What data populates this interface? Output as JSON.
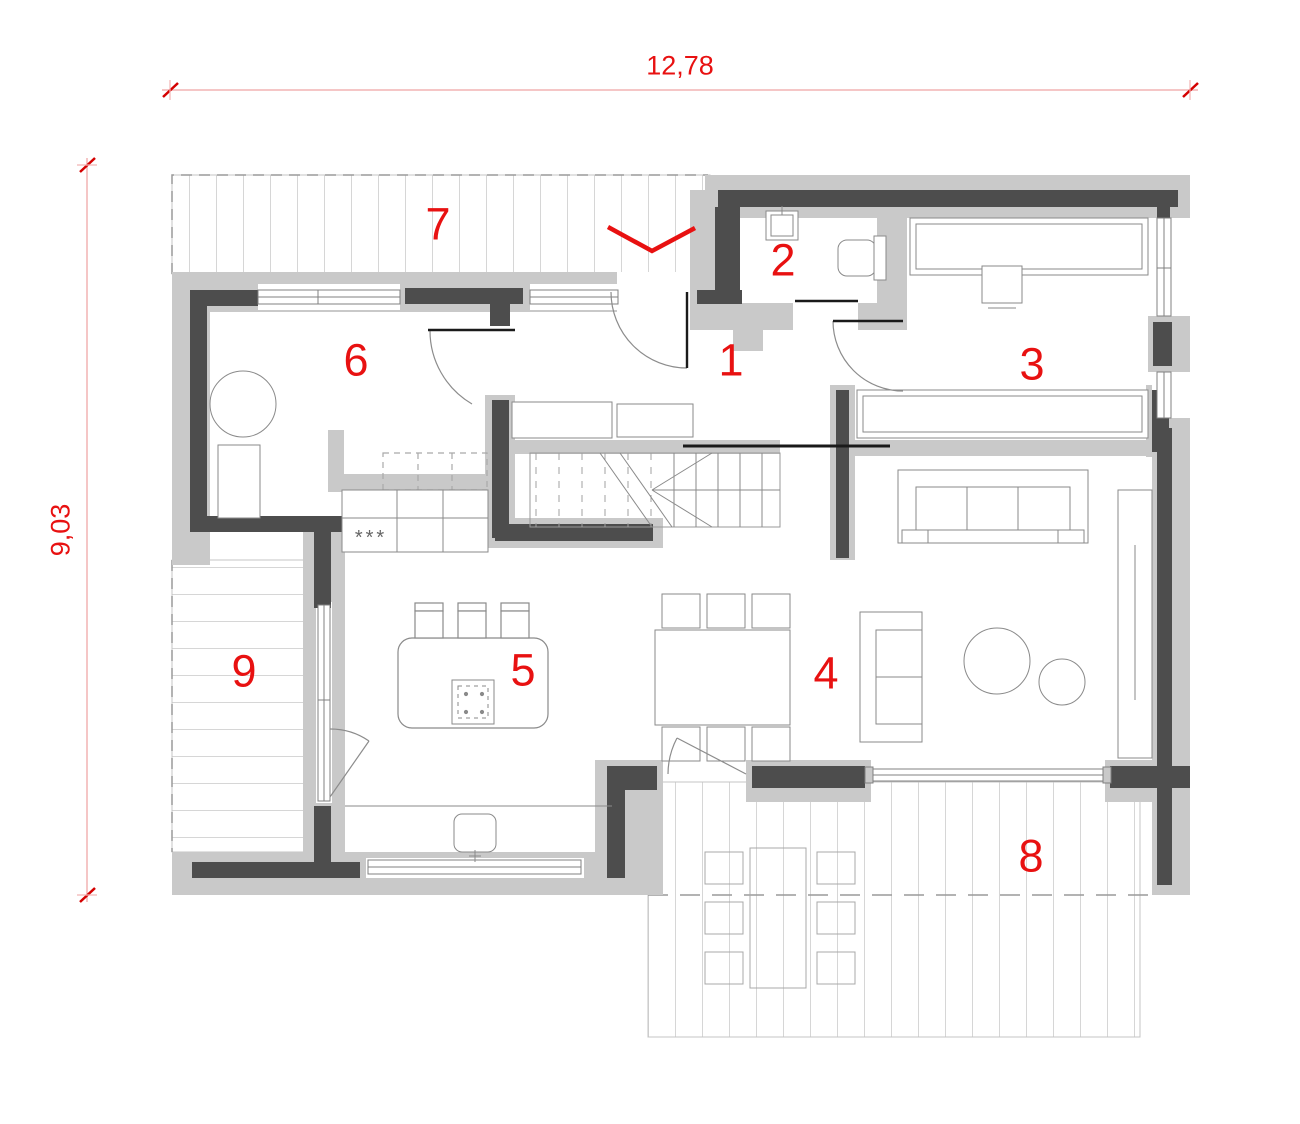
{
  "drawing": {
    "type": "architectural-floor-plan",
    "floor": "ground-floor",
    "overall_width_label": "12,78",
    "overall_depth_label": "9,03"
  },
  "dimension_labels": {
    "top": "12,78",
    "left": "9,03"
  },
  "room_labels": [
    {
      "number": "1"
    },
    {
      "number": "2"
    },
    {
      "number": "3"
    },
    {
      "number": "4"
    },
    {
      "number": "5"
    },
    {
      "number": "6"
    },
    {
      "number": "7"
    },
    {
      "number": "8"
    },
    {
      "number": "9"
    }
  ],
  "kitchen": {
    "appliance_symbol": "***"
  },
  "markers": {
    "entrance_marker": "chevron-down"
  },
  "colors": {
    "annotation_red": "#e81111",
    "wall_core": "#4d4d4d",
    "wall_fill": "#c9c9c9",
    "furniture_line": "#8a8a8a",
    "hatch_line": "#dcdcdc"
  }
}
